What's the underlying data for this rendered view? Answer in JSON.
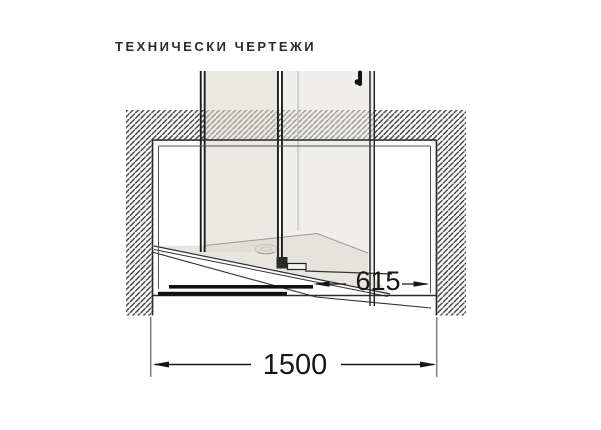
{
  "title": "ТЕХНИЧЕСКИ ЧЕРТЕЖИ",
  "drawing": {
    "dimensions": {
      "entry_width": "615",
      "total_width": "1500"
    },
    "colors": {
      "glass": "#e9e6e1",
      "tray": "#e8e5e0",
      "hatch_line": "#3f3f3f",
      "line_dark": "#232323"
    }
  }
}
